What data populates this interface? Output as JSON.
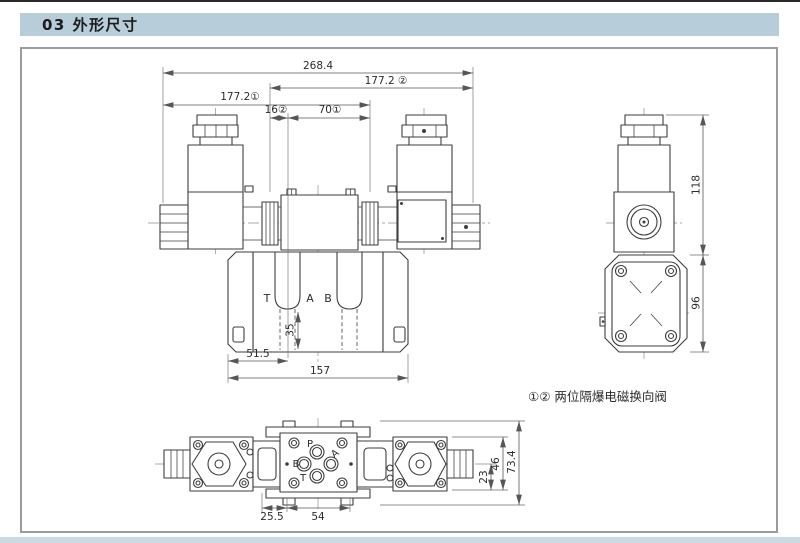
{
  "header": {
    "title": "03 外形尺寸"
  },
  "colors": {
    "header_bg": "#b7cdd9",
    "footer_bg": "#ccdae4",
    "line": "#3e3e3e",
    "frame_border": "#9c9c9c"
  },
  "note": {
    "text": "①② 两位隔爆电磁换向阀"
  },
  "front_view": {
    "dim_total_width": "268.4",
    "dim_span_right": "177.2 ②",
    "dim_span_left": "177.2①",
    "dim_offset": "16②",
    "dim_spacing": "70①",
    "dim_port_depth": "35",
    "dim_mount_offset": "51.5",
    "dim_body_width": "157",
    "port_t": "T",
    "port_a": "A",
    "port_b": "B"
  },
  "side_view": {
    "dim_height": "118",
    "dim_flange_height": "96"
  },
  "bottom_view": {
    "dim_offset": "25.5",
    "dim_spacing": "54",
    "dim_center_to_edge": "23",
    "dim_plate_height": "46",
    "dim_total_height": "73.4",
    "port_p": "P",
    "port_a": "A",
    "port_b": "B",
    "port_t": "T"
  }
}
